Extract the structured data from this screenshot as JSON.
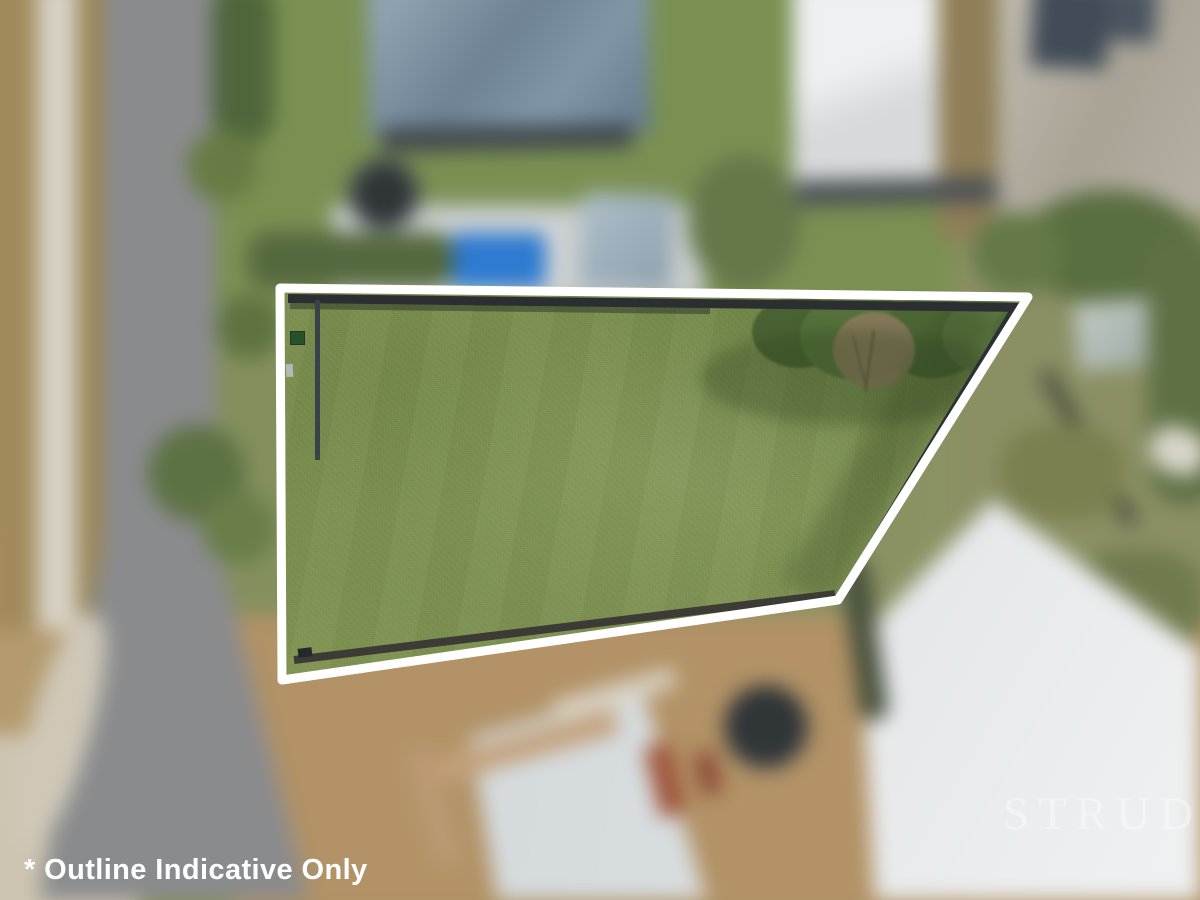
{
  "photo": {
    "caption": "* Outline Indicative Only",
    "watermark_text": "STRUD"
  },
  "lot_outline": {
    "stroke_color": "#ffffff"
  },
  "palette": {
    "lot_grass": "#7d9150",
    "outline_white": "#ffffff",
    "pool_blue": "#2d7bd2",
    "road_gray": "#8a8b8d",
    "dirt_tan": "#b29266",
    "slate_roof": "#7b8fa0",
    "white_roof": "#e8eaec",
    "tree_green": "#55703a"
  }
}
